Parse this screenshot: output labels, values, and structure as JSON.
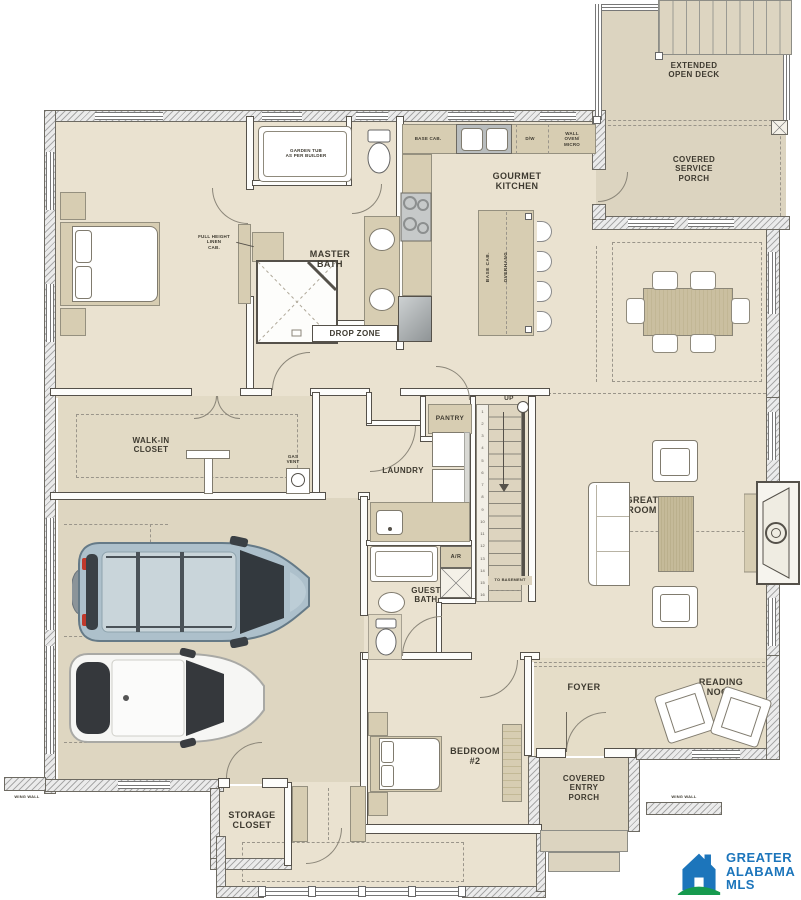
{
  "colors": {
    "floor": "#eae2d0",
    "porch": "#dcd4c0",
    "garage": "#ded6c1",
    "foyer": "#e5ddc8",
    "closet_floor": "#e2dac5",
    "cabinet": "#d7cdb2",
    "wood": "#cabfa0",
    "wall_line": "#55514a",
    "label_text": "#3e3a30",
    "logo_blue": "#1c75bb",
    "logo_green": "#169a4e"
  },
  "labels": {
    "garden_tub": "GARDEN TUB\nAS PER BUILDER",
    "full_height_linen": "FULL HEIGHT\nLINEN\nCAB.",
    "master_bath": "MASTER\nBATH",
    "drop_zone": "DROP ZONE",
    "base_cab": "BASE CAB.",
    "dw": "D/W",
    "wall_oven_micro": "WALL\nOVEN/\nMICRO",
    "gourmet_kitchen": "GOURMET\nKITCHEN",
    "island_base_cab": "BASE CAB.",
    "island_overhang": "OVERHANG",
    "extended_open_deck": "EXTENDED\nOPEN DECK",
    "covered_service_porch": "COVERED\nSERVICE\nPORCH",
    "walk_in_closet": "WALK-IN\nCLOSET",
    "gas_vent": "GAS\nVENT",
    "pantry": "PANTRY",
    "laundry": "LAUNDRY",
    "up": "UP",
    "to_basement": "TO BASEMENT",
    "ar": "A/R",
    "guest_bath": "GUEST\nBATH",
    "great_room": "GREAT\nROOM",
    "foyer": "FOYER",
    "reading_nook": "READING\nNOOK",
    "bedroom_2": "BEDROOM\n#2",
    "covered_entry_porch": "COVERED\nENTRY\nPORCH",
    "storage_closet": "STORAGE\nCLOSET",
    "wing_wall_left": "WING WALL",
    "wing_wall_right": "WING WALL"
  },
  "stairs": {
    "steps": [
      "1",
      "2",
      "3",
      "4",
      "5",
      "6",
      "7",
      "8",
      "9",
      "10",
      "11",
      "12",
      "13",
      "14",
      "15",
      "16"
    ]
  },
  "logo": {
    "line1": "GREATER",
    "line2": "ALABAMA",
    "line3": "MLS"
  }
}
